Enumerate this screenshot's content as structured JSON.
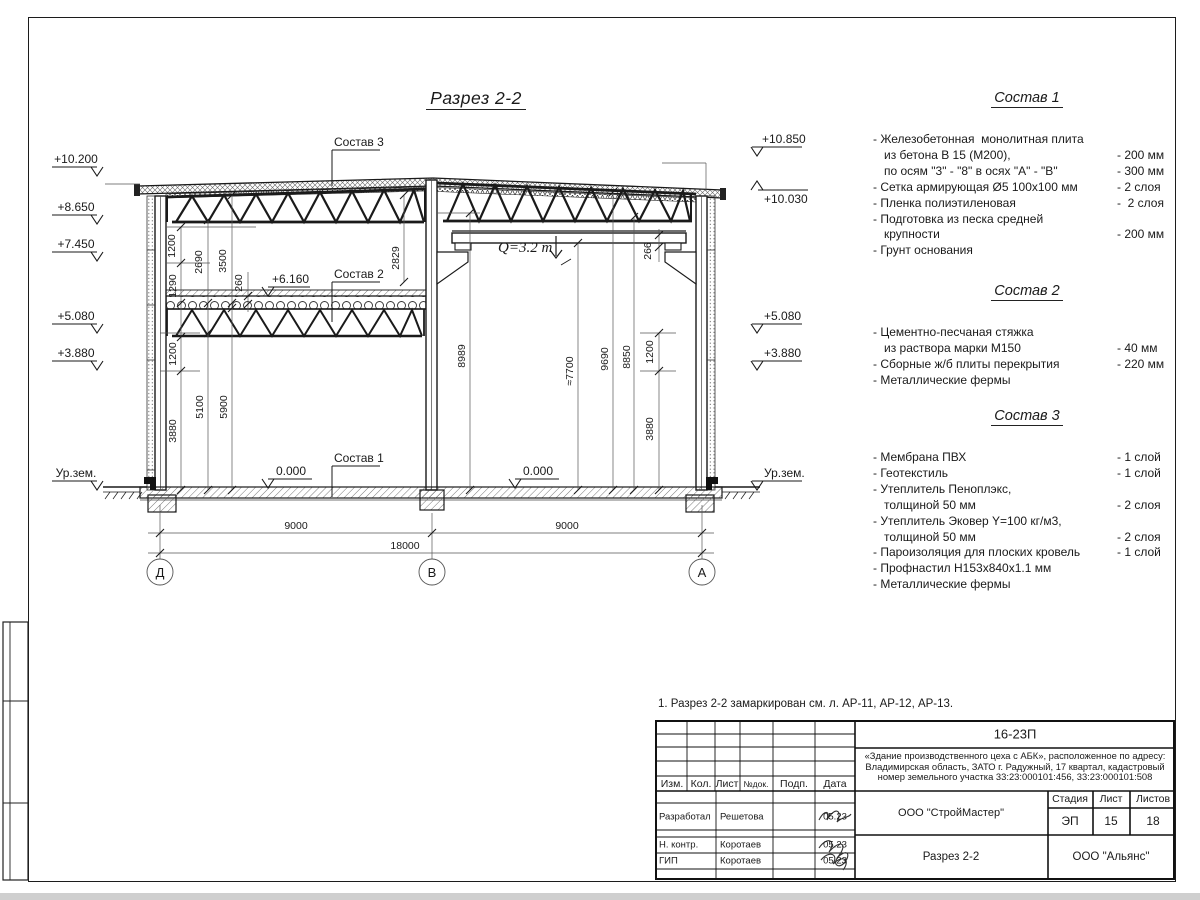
{
  "drawing": {
    "title": "Разрез 2-2",
    "elev_left": [
      "+10.200",
      "+8.650",
      "+7.450",
      "+5.080",
      "+3.880"
    ],
    "ground_left": "Ур.зем.",
    "elev_right": [
      "+10.850",
      "+10.030",
      "+5.080",
      "+3.880"
    ],
    "ground_right": "Ур.зем.",
    "zero_left": "0.000",
    "zero_right": "0.000",
    "level_slab": "+6.160",
    "labels": {
      "c1": "Состав 1",
      "c2": "Состав 2",
      "c3": "Состав 3",
      "crane": "Q=3.2 т"
    },
    "dims_left": [
      "1200",
      "2690",
      "3500",
      "1290",
      "260",
      "2829",
      "1200",
      "3880",
      "5100",
      "5900"
    ],
    "dims_right": [
      "266",
      "8989",
      "≈7700",
      "9690",
      "8850",
      "1200",
      "3880"
    ],
    "dims_bottom": [
      "9000",
      "9000",
      "18000"
    ],
    "axes": [
      "Д",
      "В",
      "А"
    ]
  },
  "compositions": [
    {
      "title": "Состав 1",
      "rows": [
        {
          "t": "- Железобетонная  монолитная плита",
          "v": ""
        },
        {
          "t": "из бетона В 15 (М200),",
          "v": "- 200 мм"
        },
        {
          "t": "по осям \"3\" - \"8\" в осях \"А\" - \"В\"",
          "v": "- 300 мм"
        },
        {
          "t": "- Сетка армирующая Ø5 100х100 мм",
          "v": "- 2 слоя"
        },
        {
          "t": "- Пленка полиэтиленовая",
          "v": "-  2 слоя"
        },
        {
          "t": "- Подготовка из песка средней",
          "v": ""
        },
        {
          "t": "крупности",
          "v": "- 200 мм"
        },
        {
          "t": "- Грунт основания",
          "v": ""
        }
      ]
    },
    {
      "title": "Состав 2",
      "rows": [
        {
          "t": "- Цементно-песчаная стяжка",
          "v": ""
        },
        {
          "t": "из раствора марки М150",
          "v": "- 40 мм"
        },
        {
          "t": "- Сборные ж/б плиты перекрытия",
          "v": "- 220 мм"
        },
        {
          "t": "- Металлические фермы",
          "v": ""
        }
      ]
    },
    {
      "title": "Состав 3",
      "rows": [
        {
          "t": "- Мембрана ПВХ",
          "v": "- 1 слой"
        },
        {
          "t": "- Геотекстиль",
          "v": "- 1 слой"
        },
        {
          "t": "- Утеплитель Пеноплэкс,",
          "v": ""
        },
        {
          "t": "толщиной 50 мм",
          "v": "- 2 слоя"
        },
        {
          "t": "- Утеплитель Эковер Y=100 кг/м3,",
          "v": ""
        },
        {
          "t": "толщиной 50 мм",
          "v": "- 2 слоя"
        },
        {
          "t": "- Пароизоляция для плоских кровель",
          "v": "- 1 слой"
        },
        {
          "t": "- Профнастил Н153х840х1.1 мм",
          "v": ""
        },
        {
          "t": "- Металлические фермы",
          "v": ""
        }
      ]
    }
  ],
  "note": "1. Разрез 2-2 замаркирован см. л. АР-11, АР-12, АР-13.",
  "titleblock": {
    "code": "16-23П",
    "object": "«Здание производственного цеха с АБК», расположенное по адресу: Владимирская область, ЗАТО г. Радужный, 17 квартал, кадастровый номер земельного участка 33:23:000101:456, 33:23:000101:508",
    "cols": {
      "izm": "Изм.",
      "kol": "Кол.",
      "list": "Лист",
      "ndok": "№док.",
      "podp": "Подп.",
      "data": "Дата"
    },
    "rows": [
      {
        "role": "Разработал",
        "name": "Решетова",
        "date": "05.23"
      },
      {
        "role": "Н. контр.",
        "name": "Коротаев",
        "date": "05.23"
      },
      {
        "role": "ГИП",
        "name": "Коротаев",
        "date": "05.23"
      }
    ],
    "org": "ООО \"СтройМастер\"",
    "stage_label": "Стадия",
    "sheet_label": "Лист",
    "sheets_label": "Листов",
    "stage": "ЭП",
    "sheet_no": "15",
    "sheets_total": "18",
    "doc_name": "Разрез 2-2",
    "customer": "ООО \"Альянс\""
  }
}
